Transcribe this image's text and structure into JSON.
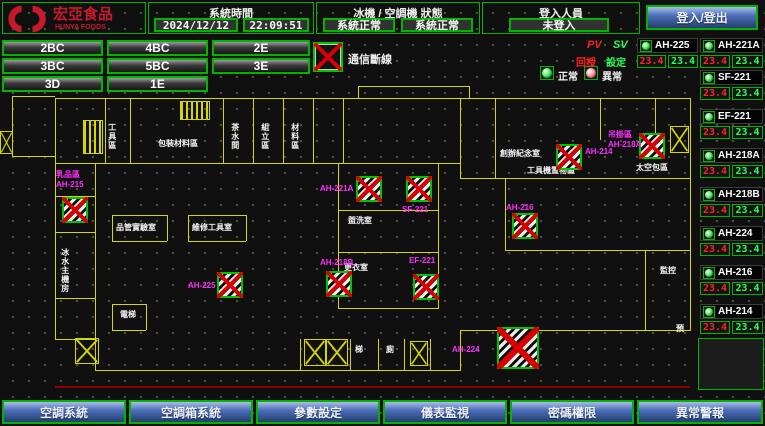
{
  "header": {
    "logo_title": "宏亞食品",
    "logo_subtitle": "HUNYA FOODS",
    "system_time_label": "系統時間",
    "date": "2024/12/12",
    "time": "22:09:51",
    "status_label": "冰機 / 空調機 狀態",
    "chiller_status": "系統正常",
    "ahu_status": "系統正常",
    "login_label": "登入人員",
    "login_status": "未登入",
    "login_button": "登入/登出"
  },
  "floor_buttons": [
    "2BC",
    "4BC",
    "2E",
    "3BC",
    "5BC",
    "3E",
    "3D",
    "1E"
  ],
  "legend": {
    "comm_loss": "通信斷線",
    "normal": "正常",
    "abnormal": "異常",
    "pv_label": "PV",
    "sv_label": "SV",
    "pv_row_label": "回授",
    "sv_row_label": "設定"
  },
  "units": {
    "top_row": [
      {
        "name": "AH-225",
        "pv": "23.4",
        "sv": "23.4"
      },
      {
        "name": "AH-221A",
        "pv": "23.4",
        "sv": "23.4"
      }
    ],
    "list": [
      {
        "name": "SF-221",
        "pv": "23.4",
        "sv": "23.4"
      },
      {
        "name": "EF-221",
        "pv": "23.4",
        "sv": "23.4"
      },
      {
        "name": "AH-218A",
        "pv": "23.4",
        "sv": "23.4"
      },
      {
        "name": "AH-218B",
        "pv": "23.4",
        "sv": "23.4"
      },
      {
        "name": "AH-224",
        "pv": "23.4",
        "sv": "23.4"
      },
      {
        "name": "AH-216",
        "pv": "23.4",
        "sv": "23.4"
      },
      {
        "name": "AH-214",
        "pv": "23.4",
        "sv": "23.4"
      }
    ]
  },
  "map": {
    "offline_units": [
      {
        "name": "乳品區",
        "name2": "AH-215",
        "x": 62,
        "y": 197,
        "lx": 56,
        "ly": 170
      },
      {
        "name": "AH-221A",
        "x": 356,
        "y": 176,
        "lx": 320,
        "ly": 184
      },
      {
        "name": "SF-221",
        "x": 406,
        "y": 176,
        "lx": 402,
        "ly": 205
      },
      {
        "name": "AH-218B",
        "x": 326,
        "y": 271,
        "lx": 320,
        "ly": 258
      },
      {
        "name": "EF-221",
        "x": 413,
        "y": 274,
        "lx": 409,
        "ly": 256
      },
      {
        "name": "AH-225",
        "x": 217,
        "y": 272,
        "lx": 188,
        "ly": 281
      },
      {
        "name": "AH-224",
        "x": 497,
        "y": 327,
        "w": 42,
        "h": 42,
        "lx": 452,
        "ly": 345
      },
      {
        "name": "AH-214",
        "x": 556,
        "y": 144,
        "lx": 585,
        "ly": 147
      },
      {
        "name": "吊掛區",
        "name2": "AH-218A",
        "x": 639,
        "y": 133,
        "lx": 608,
        "ly": 130
      },
      {
        "name": "AH-216",
        "x": 512,
        "y": 213,
        "lx": 506,
        "ly": 203
      }
    ],
    "room_labels": [
      {
        "t": "工具區",
        "x": 107,
        "y": 123,
        "v": 1
      },
      {
        "t": "包裝材料區",
        "x": 158,
        "y": 140
      },
      {
        "t": "茶水間",
        "x": 230,
        "y": 123,
        "v": 1
      },
      {
        "t": "組立區",
        "x": 260,
        "y": 123,
        "v": 1
      },
      {
        "t": "材料區",
        "x": 290,
        "y": 123,
        "v": 1
      },
      {
        "t": "創辦紀念室",
        "x": 500,
        "y": 150
      },
      {
        "t": "工具機置物區",
        "x": 527,
        "y": 167
      },
      {
        "t": "太空包區",
        "x": 636,
        "y": 164
      },
      {
        "t": "品管實驗室",
        "x": 116,
        "y": 224
      },
      {
        "t": "維修工具室",
        "x": 192,
        "y": 224
      },
      {
        "t": "冰水主機房",
        "x": 60,
        "y": 248,
        "v": 1
      },
      {
        "t": "盥洗室",
        "x": 348,
        "y": 217
      },
      {
        "t": "更衣室",
        "x": 344,
        "y": 264
      },
      {
        "t": "電梯",
        "x": 120,
        "y": 311
      },
      {
        "t": "梯",
        "x": 355,
        "y": 346
      },
      {
        "t": "廁",
        "x": 386,
        "y": 346
      },
      {
        "t": "監控",
        "x": 660,
        "y": 267
      },
      {
        "t": "預",
        "x": 676,
        "y": 325
      }
    ],
    "fan_boxes": [
      [
        0,
        131,
        13,
        23
      ],
      [
        75,
        338,
        24,
        26
      ],
      [
        304,
        339,
        22,
        27
      ],
      [
        326,
        339,
        22,
        27
      ],
      [
        410,
        341,
        18,
        25
      ],
      [
        670,
        126,
        19,
        27
      ]
    ],
    "grille_boxes": [
      [
        83,
        120,
        20,
        34
      ],
      [
        180,
        101,
        30,
        19
      ]
    ],
    "red_lines": [
      [
        55,
        386,
        635,
        2
      ]
    ],
    "walls": [
      [
        358,
        86,
        112,
        1
      ],
      [
        358,
        86,
        1,
        13
      ],
      [
        469,
        86,
        1,
        13
      ],
      [
        55,
        98,
        636,
        1
      ],
      [
        55,
        98,
        1,
        242
      ],
      [
        690,
        98,
        1,
        233
      ],
      [
        55,
        339,
        41,
        1
      ],
      [
        95,
        339,
        1,
        31
      ],
      [
        95,
        370,
        366,
        1
      ],
      [
        460,
        330,
        1,
        41
      ],
      [
        460,
        330,
        230,
        1
      ],
      [
        55,
        163,
        405,
        1
      ],
      [
        105,
        98,
        1,
        65
      ],
      [
        130,
        98,
        1,
        65
      ],
      [
        223,
        98,
        1,
        65
      ],
      [
        253,
        98,
        1,
        65
      ],
      [
        283,
        98,
        1,
        65
      ],
      [
        313,
        98,
        1,
        65
      ],
      [
        343,
        98,
        1,
        65
      ],
      [
        460,
        98,
        1,
        80
      ],
      [
        460,
        178,
        230,
        1
      ],
      [
        495,
        98,
        1,
        80
      ],
      [
        600,
        98,
        1,
        42
      ],
      [
        655,
        98,
        1,
        42
      ],
      [
        338,
        163,
        1,
        145
      ],
      [
        438,
        163,
        1,
        145
      ],
      [
        338,
        308,
        101,
        1
      ],
      [
        338,
        210,
        100,
        1
      ],
      [
        338,
        252,
        100,
        1
      ],
      [
        95,
        163,
        1,
        77
      ],
      [
        55,
        196,
        40,
        1
      ],
      [
        55,
        232,
        40,
        1
      ],
      [
        55,
        298,
        40,
        1
      ],
      [
        95,
        240,
        1,
        99
      ],
      [
        112,
        215,
        55,
        1
      ],
      [
        112,
        241,
        55,
        1
      ],
      [
        112,
        215,
        1,
        26
      ],
      [
        167,
        215,
        1,
        26
      ],
      [
        188,
        215,
        58,
        1
      ],
      [
        188,
        241,
        58,
        1
      ],
      [
        188,
        215,
        1,
        26
      ],
      [
        246,
        215,
        1,
        26
      ],
      [
        112,
        304,
        34,
        1
      ],
      [
        112,
        330,
        34,
        1
      ],
      [
        112,
        304,
        1,
        26
      ],
      [
        146,
        304,
        1,
        26
      ],
      [
        300,
        339,
        1,
        31
      ],
      [
        350,
        339,
        1,
        31
      ],
      [
        378,
        339,
        1,
        31
      ],
      [
        404,
        339,
        1,
        31
      ],
      [
        430,
        339,
        1,
        31
      ],
      [
        505,
        178,
        1,
        72
      ],
      [
        505,
        250,
        185,
        1
      ],
      [
        645,
        250,
        1,
        80
      ],
      [
        12,
        96,
        43,
        1
      ],
      [
        12,
        96,
        1,
        60
      ],
      [
        12,
        156,
        43,
        1
      ]
    ]
  },
  "nav_buttons": [
    "空調系統",
    "空調箱系統",
    "參數設定",
    "儀表監視",
    "密碼權限",
    "異常警報"
  ],
  "colors": {
    "accent_green": "#00b400",
    "wall_yellow": "#d6d600",
    "pv_red": "#ff2222",
    "sv_green": "#2aff55",
    "offline_magenta": "#ff2cff",
    "logo_red": "#c8192b",
    "button_blue": "#4a6db8"
  }
}
